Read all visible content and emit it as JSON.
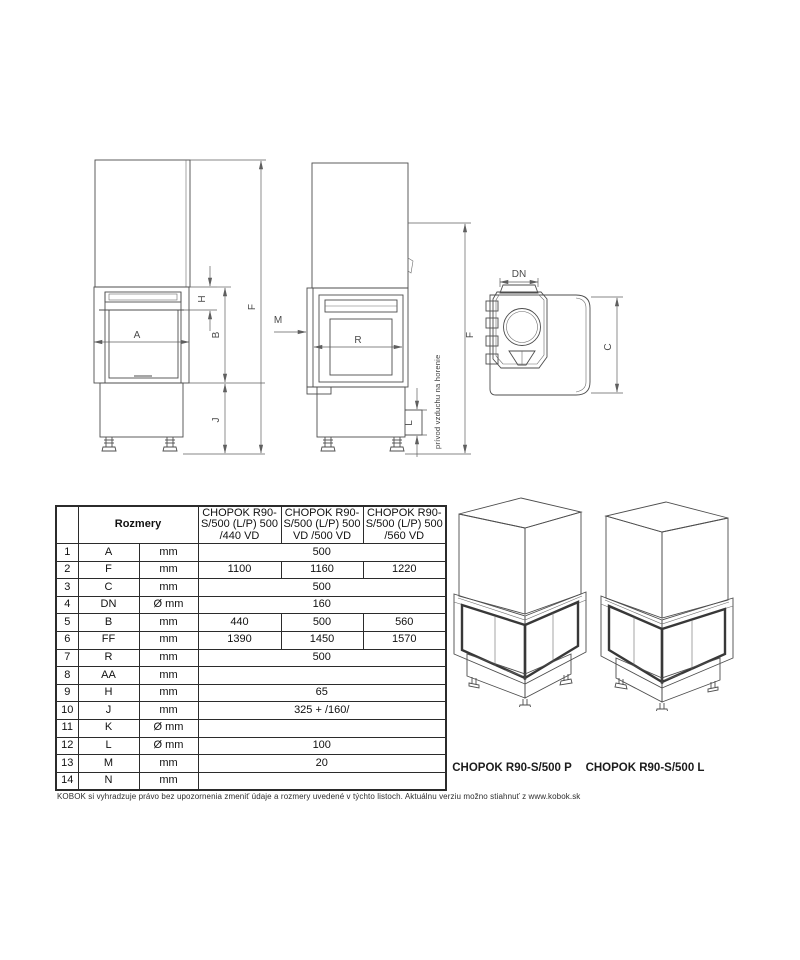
{
  "page": {
    "background": "#ffffff",
    "line_color": "#4d4d4d",
    "dim_color": "#5f5f5f"
  },
  "drawings": {
    "front": {
      "labels": {
        "A": "A",
        "H": "H",
        "B": "B",
        "J": "J",
        "F": "F"
      }
    },
    "side": {
      "labels": {
        "M": "M",
        "R": "R",
        "L": "L",
        "F": "F"
      },
      "air_note": "prívod vzduchu na horenie"
    },
    "top": {
      "labels": {
        "DN": "DN",
        "C": "C"
      }
    }
  },
  "table": {
    "header": {
      "rozmery": "Rozmery",
      "columns": [
        "CHOPOK R90-S/500 (L/P) 500 /440 VD",
        "CHOPOK R90-S/500 (L/P) 500 VD /500 VD",
        "CHOPOK R90-S/500 (L/P) 500 /560 VD"
      ]
    },
    "rows": [
      {
        "num": "1",
        "dim": "A",
        "unit": "mm",
        "values": [
          "500"
        ]
      },
      {
        "num": "2",
        "dim": "F",
        "unit": "mm",
        "values": [
          "1100",
          "1160",
          "1220"
        ]
      },
      {
        "num": "3",
        "dim": "C",
        "unit": "mm",
        "values": [
          "500"
        ]
      },
      {
        "num": "4",
        "dim": "DN",
        "unit": "Ø mm",
        "values": [
          "160"
        ]
      },
      {
        "num": "5",
        "dim": "B",
        "unit": "mm",
        "values": [
          "440",
          "500",
          "560"
        ]
      },
      {
        "num": "6",
        "dim": "FF",
        "unit": "mm",
        "values": [
          "1390",
          "1450",
          "1570"
        ]
      },
      {
        "num": "7",
        "dim": "R",
        "unit": "mm",
        "values": [
          "500"
        ]
      },
      {
        "num": "8",
        "dim": "AA",
        "unit": "mm",
        "values": [
          ""
        ]
      },
      {
        "num": "9",
        "dim": "H",
        "unit": "mm",
        "values": [
          "65"
        ]
      },
      {
        "num": "10",
        "dim": "J",
        "unit": "mm",
        "values": [
          "325 + /160/"
        ]
      },
      {
        "num": "11",
        "dim": "K",
        "unit": "Ø mm",
        "values": [
          ""
        ]
      },
      {
        "num": "12",
        "dim": "L",
        "unit": "Ø mm",
        "values": [
          "100"
        ]
      },
      {
        "num": "13",
        "dim": "M",
        "unit": "mm",
        "values": [
          "20"
        ]
      },
      {
        "num": "14",
        "dim": "N",
        "unit": "mm",
        "values": [
          ""
        ]
      }
    ]
  },
  "models": {
    "left_caption": "CHOPOK R90-S/500 P",
    "right_caption": "CHOPOK R90-S/500 L"
  },
  "footer_note": "KOBOK si vyhradzuje právo bez upozornenia zmeniť údaje a rozmery uvedené v týchto listoch. Aktuálnu verziu možno stiahnuť z www.kobok.sk"
}
